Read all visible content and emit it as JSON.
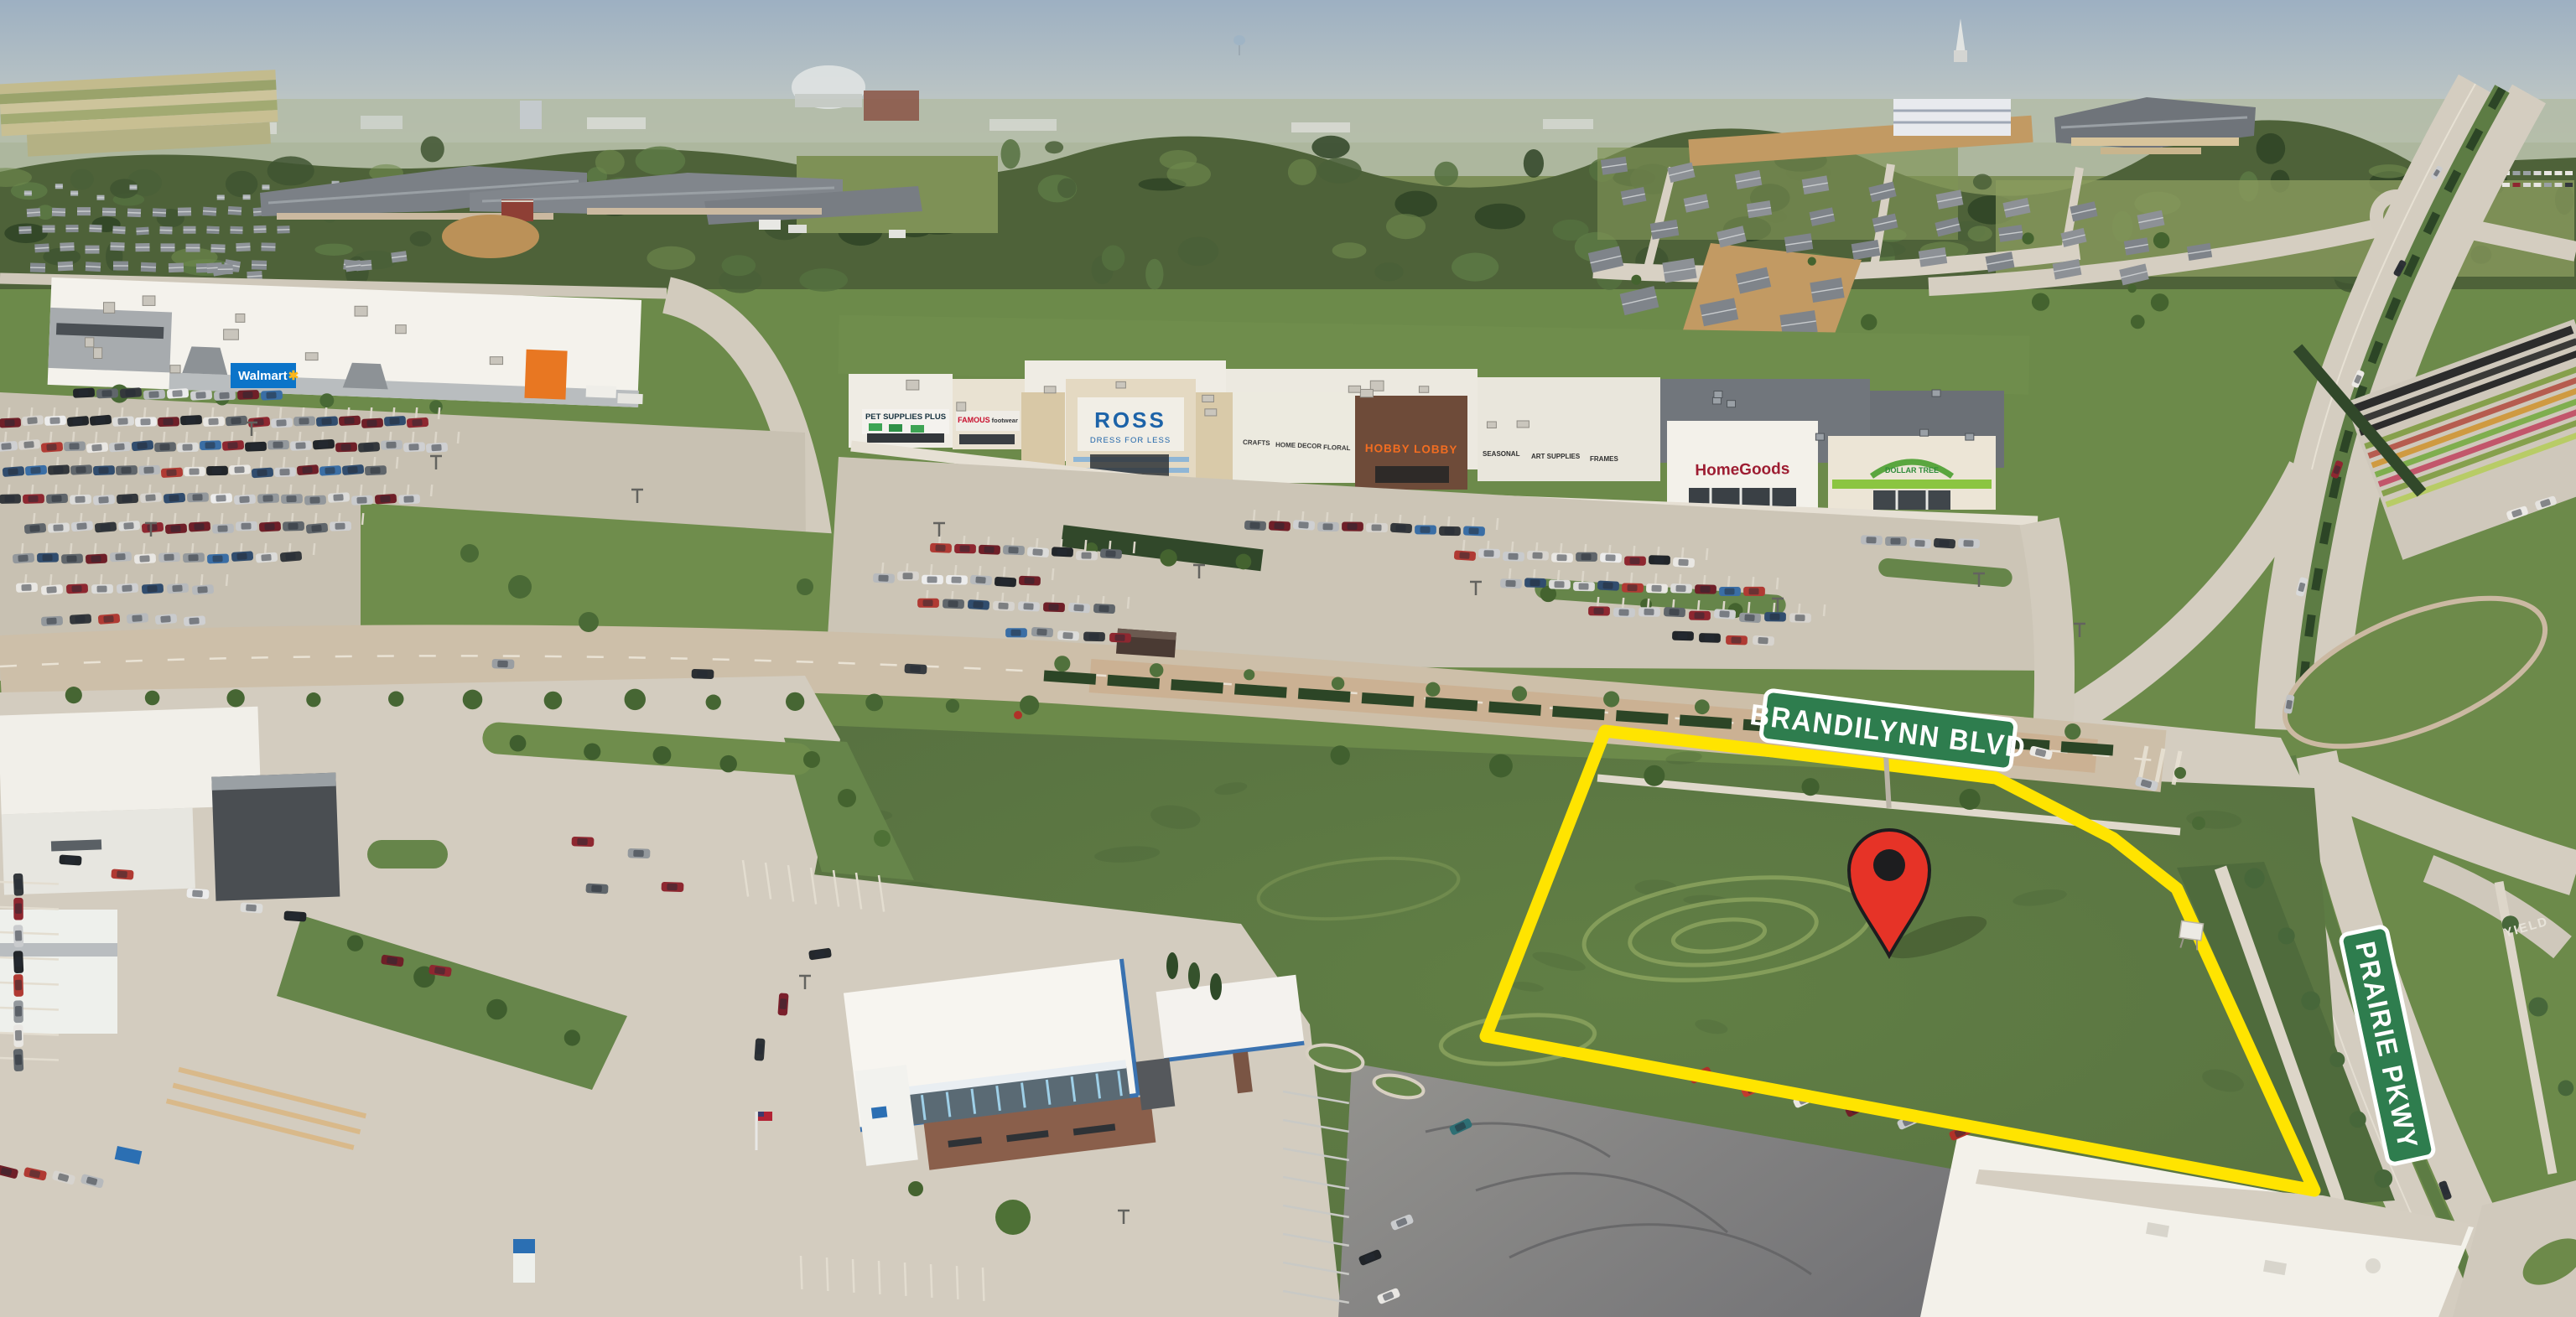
{
  "street_signs": {
    "brandilynn_blvd": "BRANDILYNN BLVD",
    "prairie_pkwy": "PRAIRIE PKWY",
    "sign_color": "#2e7d4e"
  },
  "road_markings": {
    "yield": "YIELD"
  },
  "parcel": {
    "outline_color": "#ffe400"
  },
  "map_marker": {
    "color": "#e63327"
  },
  "stores": {
    "walmart": {
      "name": "Walmart",
      "spark": "✱",
      "brand_color": "#0b74c9"
    },
    "pet_supplies_plus": {
      "name": "PET SUPPLIES PLUS"
    },
    "famous_footwear": {
      "name": "FAMOUS",
      "sub": "footwear",
      "brand_color": "#c8102e"
    },
    "ross": {
      "name": "ROSS",
      "tagline": "DRESS FOR LESS",
      "brand_color": "#1d63a8"
    },
    "hobby_lobby": {
      "name": "HOBBY LOBBY",
      "brand_color": "#f26d21",
      "wall_left": [
        "CRAFTS",
        "HOME DECOR",
        "FLORAL"
      ],
      "wall_right": [
        "SEASONAL",
        "ART SUPPLIES",
        "FRAMES"
      ]
    },
    "homegoods": {
      "name": "HomeGoods",
      "brand_color": "#9d1d32"
    },
    "dollar_tree": {
      "name": "DOLLAR TREE",
      "brand_color": "#2e8b3a"
    }
  }
}
